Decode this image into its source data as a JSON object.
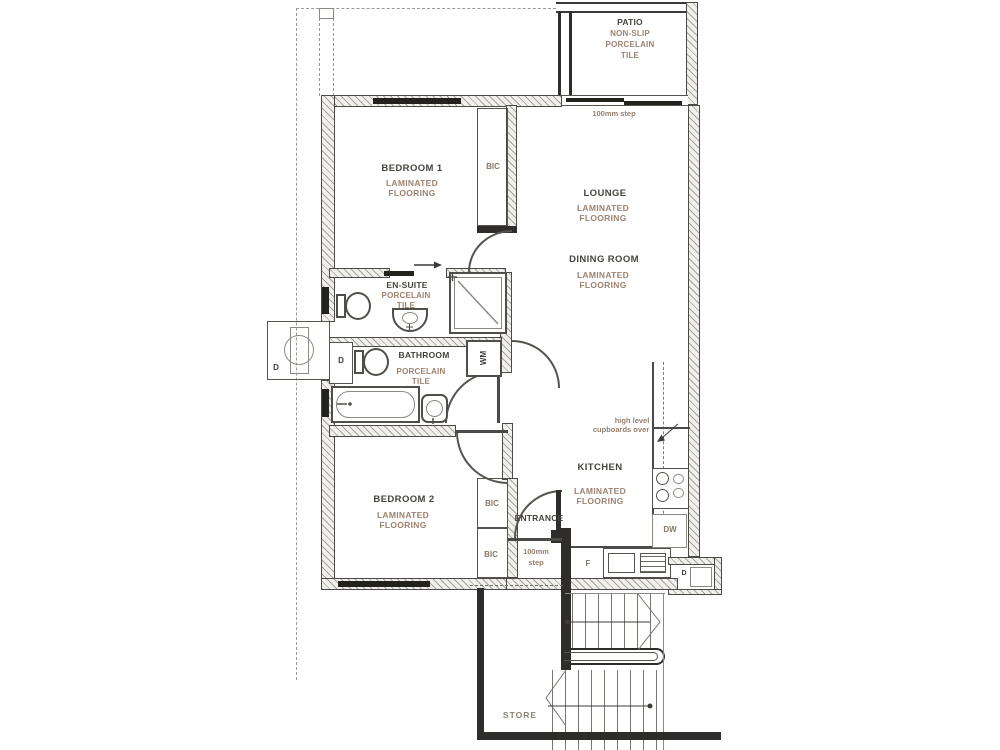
{
  "drawing_type": "apartment floor plan",
  "colors": {
    "wall_line": "#4a4a48",
    "wall_dark": "#2e2d2b",
    "room_label": "#45443f",
    "finish_label": "#9c8372",
    "window": "#23221f"
  },
  "rooms": {
    "patio": "PATIO",
    "bedroom1": "BEDROOM 1",
    "lounge": "LOUNGE",
    "dining": "DINING ROOM",
    "ensuite": "EN-SUITE",
    "bathroom": "BATHROOM",
    "kitchen": "KITCHEN",
    "bedroom2": "BEDROOM 2",
    "entrance": "ENTRANCE",
    "store": "STORE"
  },
  "finishes": {
    "laminated": "LAMINATED",
    "flooring": "FLOORING",
    "porcelain": "PORCELAIN",
    "tile": "TILE",
    "non_slip": "NON-SLIP"
  },
  "labels": {
    "bic": "BIC",
    "wm": "WM",
    "duct": "D",
    "fridge": "F",
    "dishwasher": "DW",
    "step_note": "100mm step",
    "step_line1": "100mm",
    "step_line2": "step",
    "cupboards_line1": "high level",
    "cupboards_line2": "cupboards over"
  }
}
